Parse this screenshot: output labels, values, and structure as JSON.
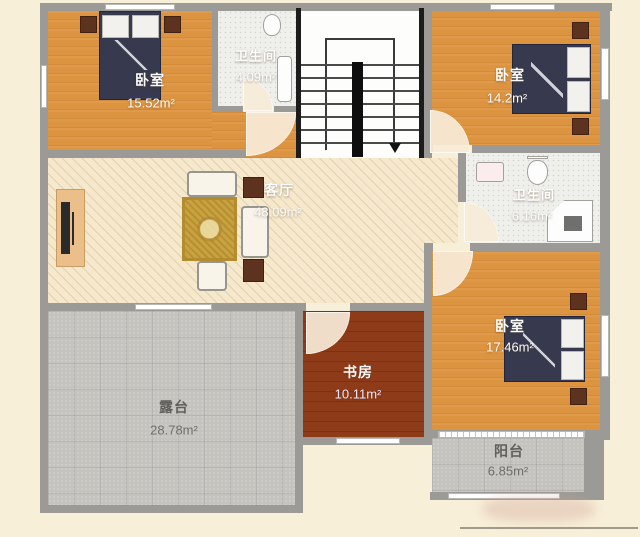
{
  "rooms": {
    "bedroom_top_left": {
      "name": "卧室",
      "area": "15.52m²"
    },
    "bathroom_top": {
      "name": "卫生间",
      "area": "4.09m²"
    },
    "bedroom_top_right": {
      "name": "卧室",
      "area": "14.2m²"
    },
    "living_room": {
      "name": "客厅",
      "area": "48.09m²"
    },
    "bathroom_mid": {
      "name": "卫生间",
      "area": "6.16m²"
    },
    "bedroom_bottom_right": {
      "name": "卧室",
      "area": "17.46m²"
    },
    "study": {
      "name": "书房",
      "area": "10.11m²"
    },
    "terrace": {
      "name": "露台",
      "area": "28.78m²"
    },
    "balcony": {
      "name": "阳台",
      "area": "6.85m²"
    }
  },
  "colors": {
    "background": "#f8efd9",
    "wall": "#9b9a96",
    "bedroom_floor": "#dd9440",
    "living_floor": "#f5e8cc",
    "study_floor": "#8e3b1a",
    "terrace_floor": "#c5c3be",
    "bathroom_floor": "#efefec",
    "bed": "#373a4e",
    "nightstand": "#5d3320",
    "rug": "#c9a23e"
  }
}
